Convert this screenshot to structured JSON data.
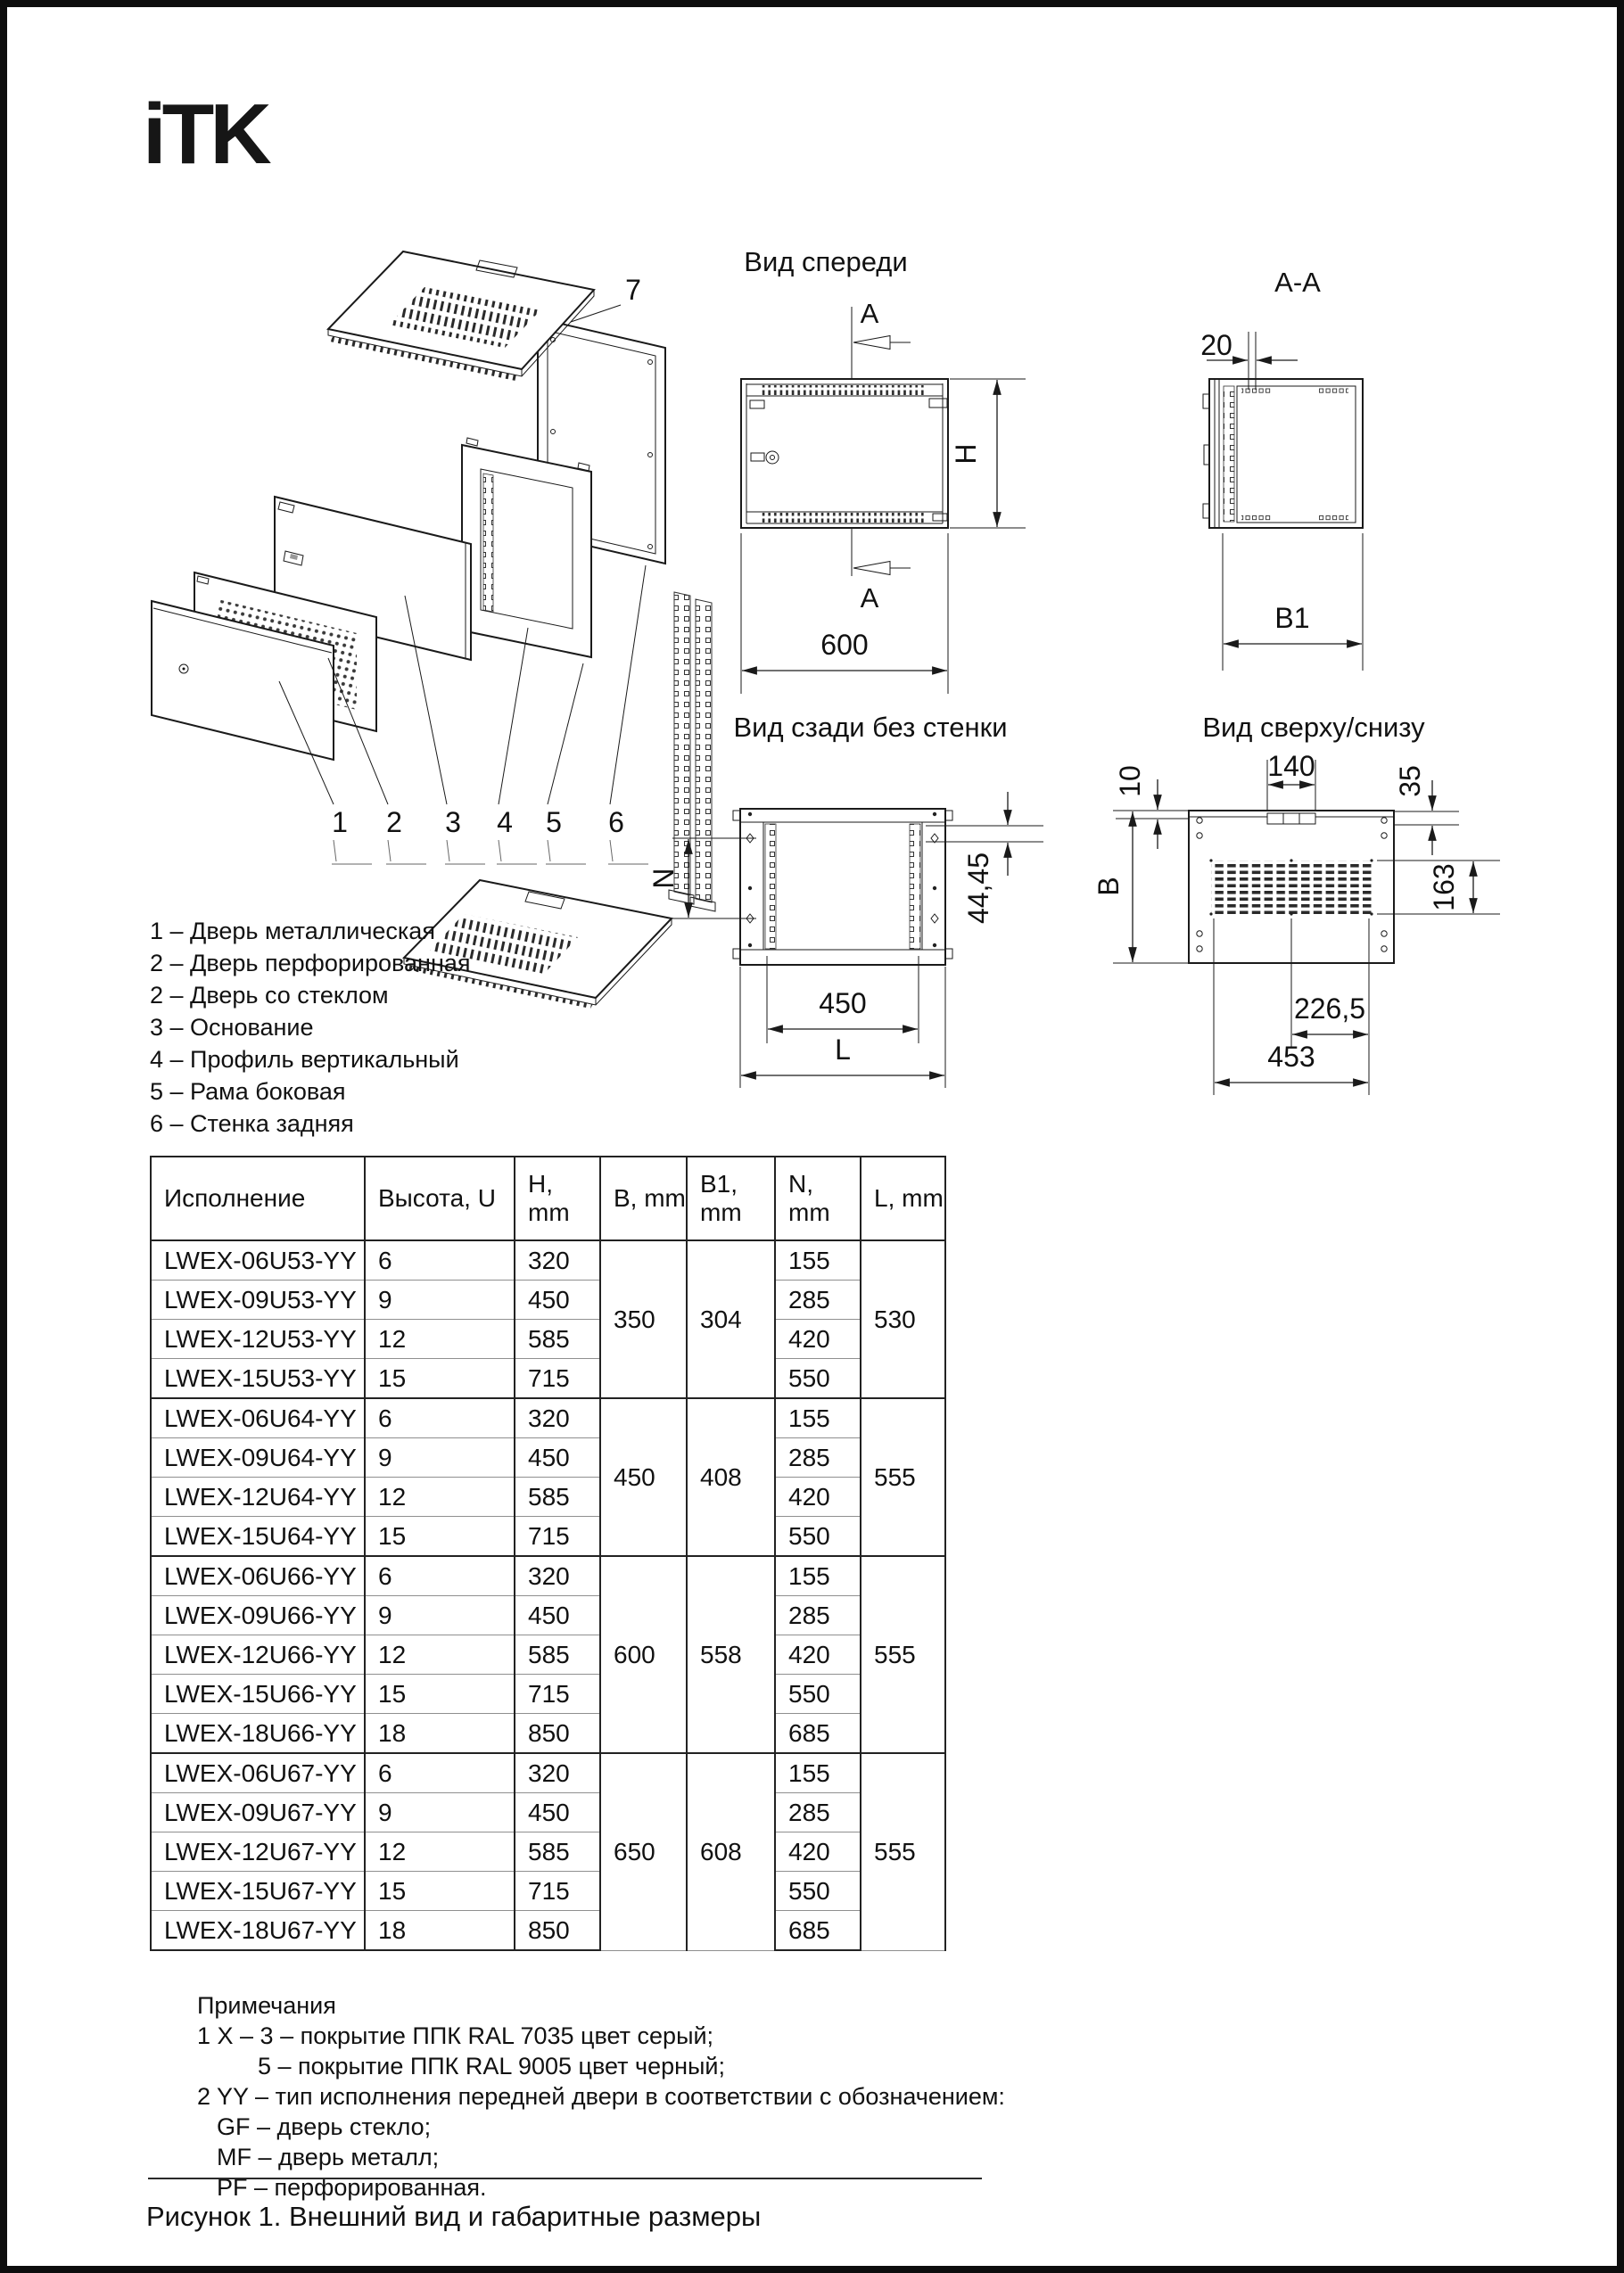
{
  "page": {
    "brand": "iTK",
    "caption": "Рисунок 1. Внешний вид и габаритные размеры"
  },
  "exploded": {
    "labels": [
      "1",
      "2",
      "3",
      "4",
      "5",
      "6",
      "7"
    ]
  },
  "front_view": {
    "title": "Вид спереди",
    "section_label": "A",
    "width": "600",
    "height": "H"
  },
  "section_view": {
    "title": "A-A",
    "thickness": "20",
    "depth": "B1"
  },
  "rear_view": {
    "title": "Вид сзади без стенки",
    "n": "N",
    "unit": "44,45",
    "inner_width": "450",
    "length": "L"
  },
  "top_view": {
    "title": "Вид сверху/снизу",
    "offset": "10",
    "slot": "140",
    "wall": "35",
    "depth": "B",
    "vent": "163",
    "half": "226,5",
    "full": "453"
  },
  "legend": {
    "items": [
      "1 – Дверь металлическая",
      "2 – Дверь перфорированная",
      "2 – Дверь со стеклом",
      "3 – Основание",
      "4 – Профиль вертикальный",
      "5 – Рама боковая",
      "6 – Стенка задняя"
    ]
  },
  "table": {
    "headers": [
      "Исполнение",
      "Высота, U",
      "H, mm",
      "B, mm",
      "B1, mm",
      "N, mm",
      "L, mm"
    ],
    "groups": [
      {
        "b": "350",
        "b1": "304",
        "l": "530",
        "rows": [
          {
            "model": "LWEX-06U53-YY",
            "u": "6",
            "h": "320",
            "n": "155"
          },
          {
            "model": "LWEX-09U53-YY",
            "u": "9",
            "h": "450",
            "n": "285"
          },
          {
            "model": "LWEX-12U53-YY",
            "u": "12",
            "h": "585",
            "n": "420"
          },
          {
            "model": "LWEX-15U53-YY",
            "u": "15",
            "h": "715",
            "n": "550"
          }
        ]
      },
      {
        "b": "450",
        "b1": "408",
        "l": "555",
        "rows": [
          {
            "model": "LWEX-06U64-YY",
            "u": "6",
            "h": "320",
            "n": "155"
          },
          {
            "model": "LWEX-09U64-YY",
            "u": "9",
            "h": "450",
            "n": "285"
          },
          {
            "model": "LWEX-12U64-YY",
            "u": "12",
            "h": "585",
            "n": "420"
          },
          {
            "model": "LWEX-15U64-YY",
            "u": "15",
            "h": "715",
            "n": "550"
          }
        ]
      },
      {
        "b": "600",
        "b1": "558",
        "l": "555",
        "rows": [
          {
            "model": "LWEX-06U66-YY",
            "u": "6",
            "h": "320",
            "n": "155"
          },
          {
            "model": "LWEX-09U66-YY",
            "u": "9",
            "h": "450",
            "n": "285"
          },
          {
            "model": "LWEX-12U66-YY",
            "u": "12",
            "h": "585",
            "n": "420"
          },
          {
            "model": "LWEX-15U66-YY",
            "u": "15",
            "h": "715",
            "n": "550"
          },
          {
            "model": "LWEX-18U66-YY",
            "u": "18",
            "h": "850",
            "n": "685"
          }
        ]
      },
      {
        "b": "650",
        "b1": "608",
        "l": "555",
        "rows": [
          {
            "model": "LWEX-06U67-YY",
            "u": "6",
            "h": "320",
            "n": "155"
          },
          {
            "model": "LWEX-09U67-YY",
            "u": "9",
            "h": "450",
            "n": "285"
          },
          {
            "model": "LWEX-12U67-YY",
            "u": "12",
            "h": "585",
            "n": "420"
          },
          {
            "model": "LWEX-15U67-YY",
            "u": "15",
            "h": "715",
            "n": "550"
          },
          {
            "model": "LWEX-18U67-YY",
            "u": "18",
            "h": "850",
            "n": "685"
          }
        ]
      }
    ]
  },
  "notes": {
    "title": "Примечания",
    "lines": [
      "1 X – 3 – покрытие ППК RAL 7035 цвет серый;",
      "5 – покрытие ППК RAL 9005 цвет черный;",
      "2 YY – тип исполнения передней двери в соответствии с обозначением:",
      "GF – дверь стекло;",
      "MF – дверь металл;",
      "PF – перфорированная."
    ]
  }
}
